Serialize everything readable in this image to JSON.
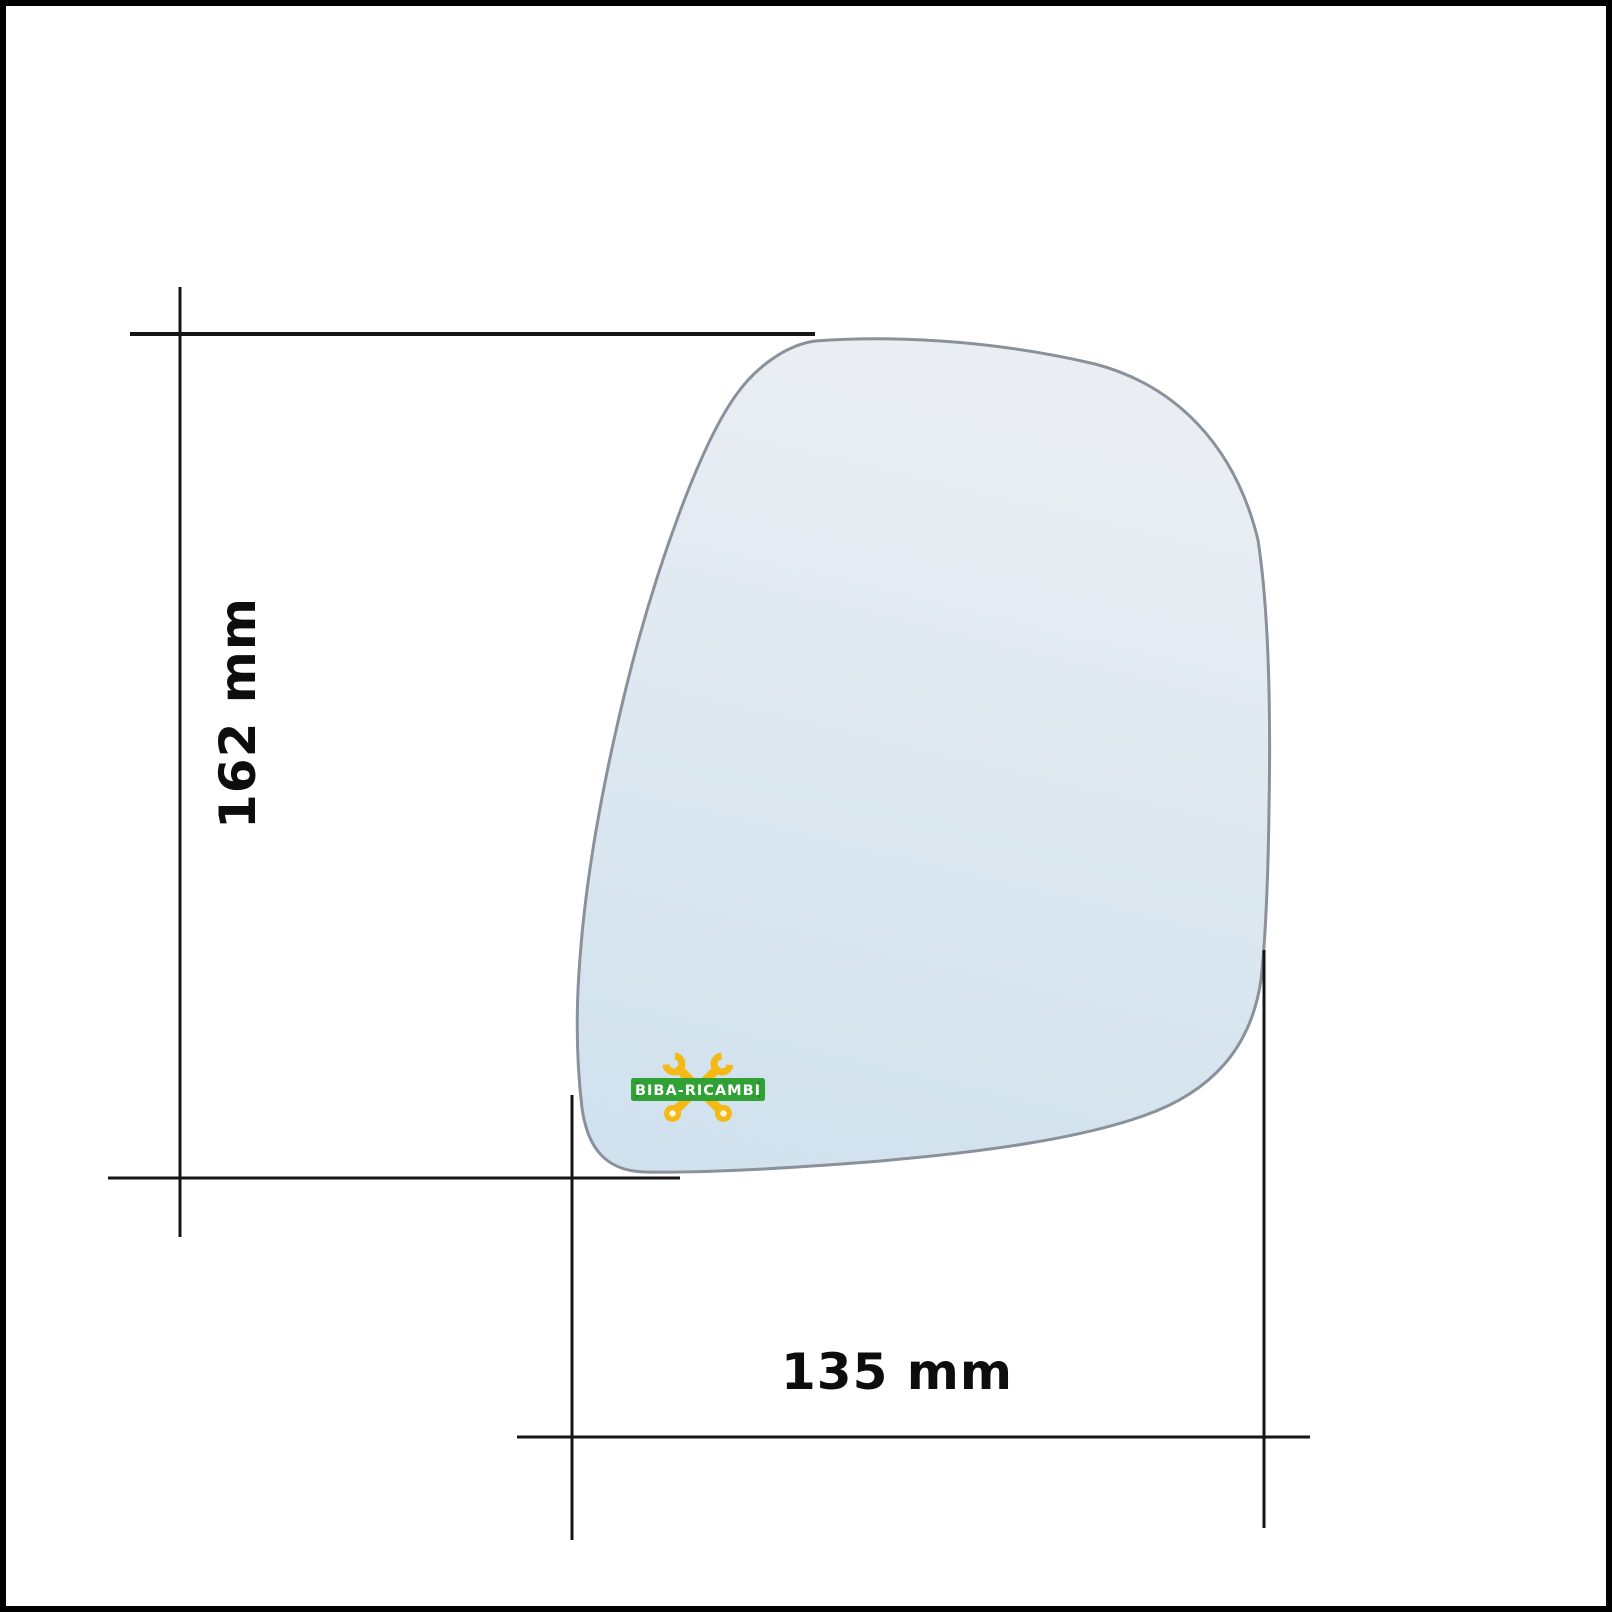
{
  "diagram": {
    "type": "technical-dimension-diagram",
    "subject": "replacement side mirror glass with measurement lines",
    "height_label": "162 mm",
    "width_label": "135 mm"
  },
  "mirror": {
    "fill_top": "#eaeef3",
    "fill_bottom": "#cfe1ed",
    "stroke": "#8a919b"
  },
  "logo": {
    "text": "BIBA-RICAMBI",
    "banner_color": "#31a136",
    "banner_screw_color": "#27862c",
    "wrench_color": "#f5b916",
    "wrench_hole_color": "#fdf6e3",
    "text_color": "#ffffff"
  },
  "colors": {
    "background": "#ffffff",
    "frame": "#000000",
    "dimension_line": "#161616",
    "label_text": "#0d0d0d"
  }
}
